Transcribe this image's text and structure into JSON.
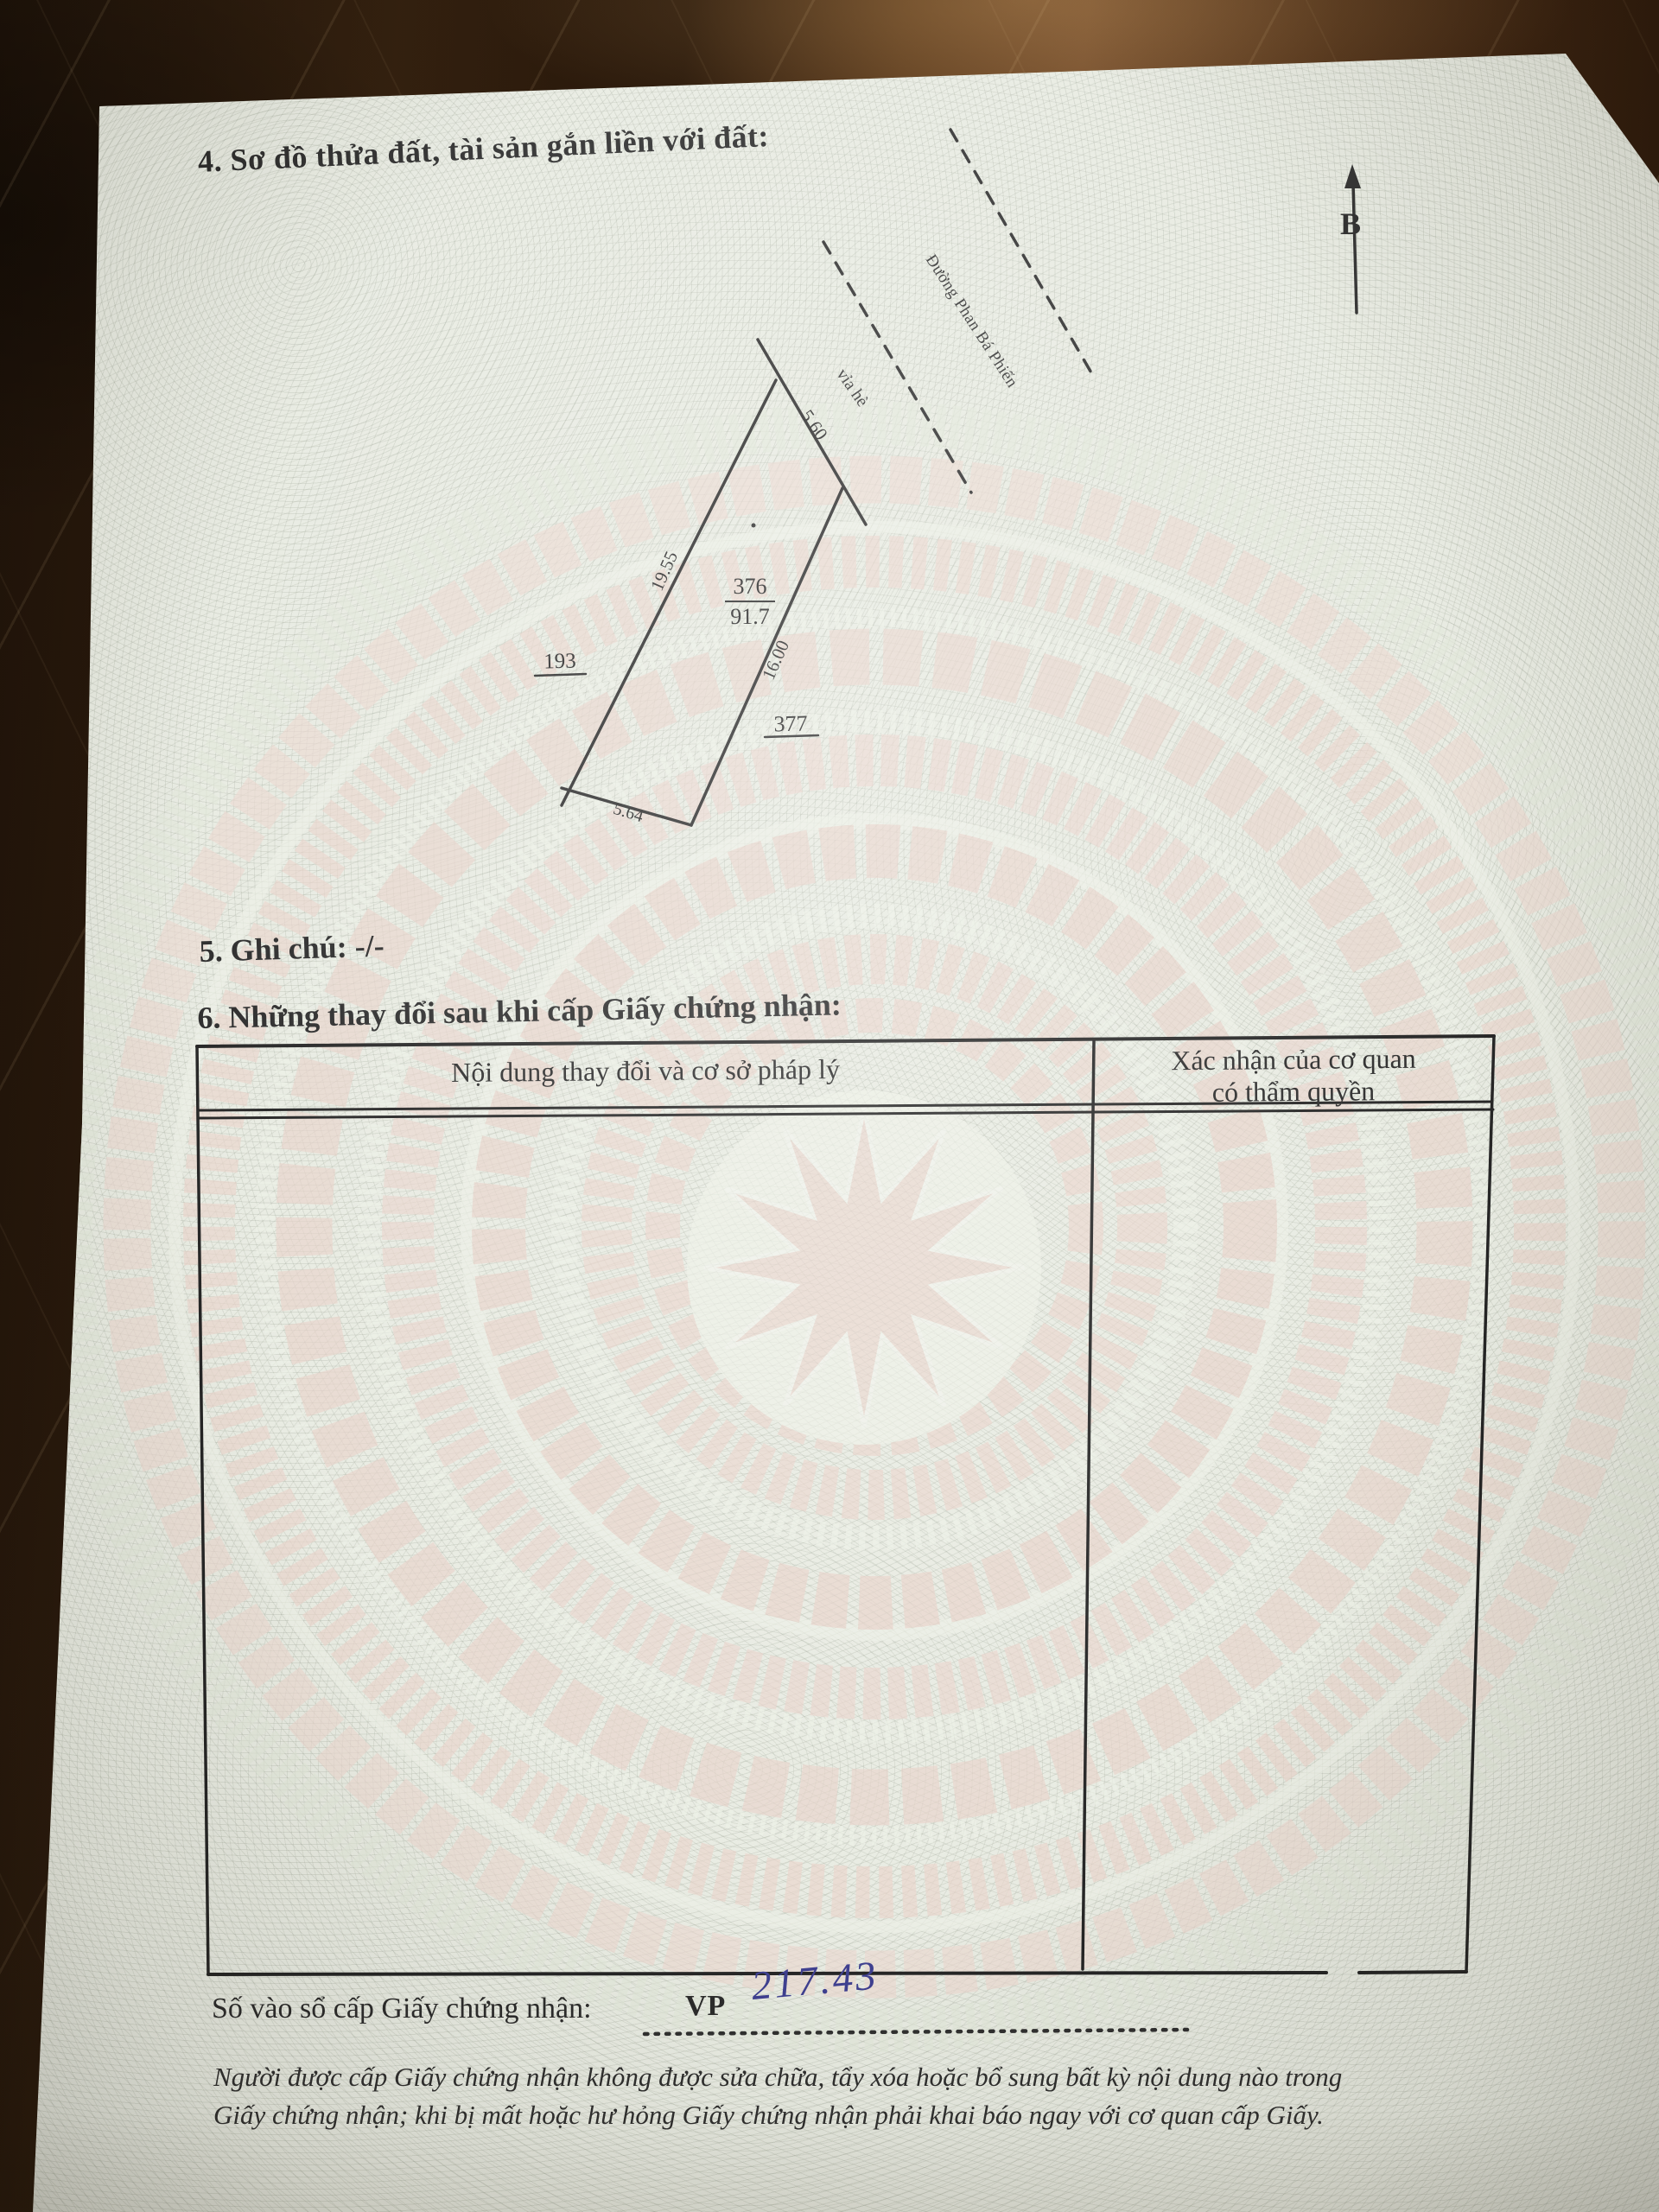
{
  "document": {
    "section4_title": "4. Sơ đồ thửa đất, tài sản gắn liền với đất:",
    "section5_title": "5. Ghi chú: -/-",
    "section6_title": "6. Những thay đổi sau khi cấp Giấy chứng nhận:"
  },
  "compass": {
    "north_label": "B"
  },
  "diagram": {
    "street_name": "Đường Phan Bá Phiến",
    "sidewalk_label": "vỉa hè",
    "parcel_number": "376",
    "parcel_area": "91.7",
    "adjacent_parcel_left": "193",
    "adjacent_parcel_right": "377",
    "dim_top": "5.60",
    "dim_left": "19.55",
    "dim_right": "16.00",
    "dim_bottom": "5.64"
  },
  "table": {
    "col1_header": "Nội dung thay đổi và cơ sở pháp lý",
    "col2_header_line1": "Xác nhận của cơ quan",
    "col2_header_line2": "có thẩm quyền"
  },
  "registry": {
    "label": "Số vào sổ cấp Giấy chứng nhận:",
    "series_prefix": "VP",
    "handwritten_number": "217.43"
  },
  "footer": {
    "line1": "Người được cấp Giấy chứng nhận không được sửa chữa, tẩy xóa hoặc bổ sung bất kỳ nội dung nào trong",
    "line2": "Giấy chứng nhận; khi bị mất hoặc hư hỏng Giấy chứng nhận phải khai báo ngay với cơ quan cấp Giấy."
  },
  "colors": {
    "ink": "#2b2b2b",
    "handwriting_ink": "#3d3e8f",
    "paper": "#e8ebe2",
    "drum_pink": "#ebd4cb",
    "wood_dark": "#24150a",
    "wood_light": "#6e482a"
  }
}
